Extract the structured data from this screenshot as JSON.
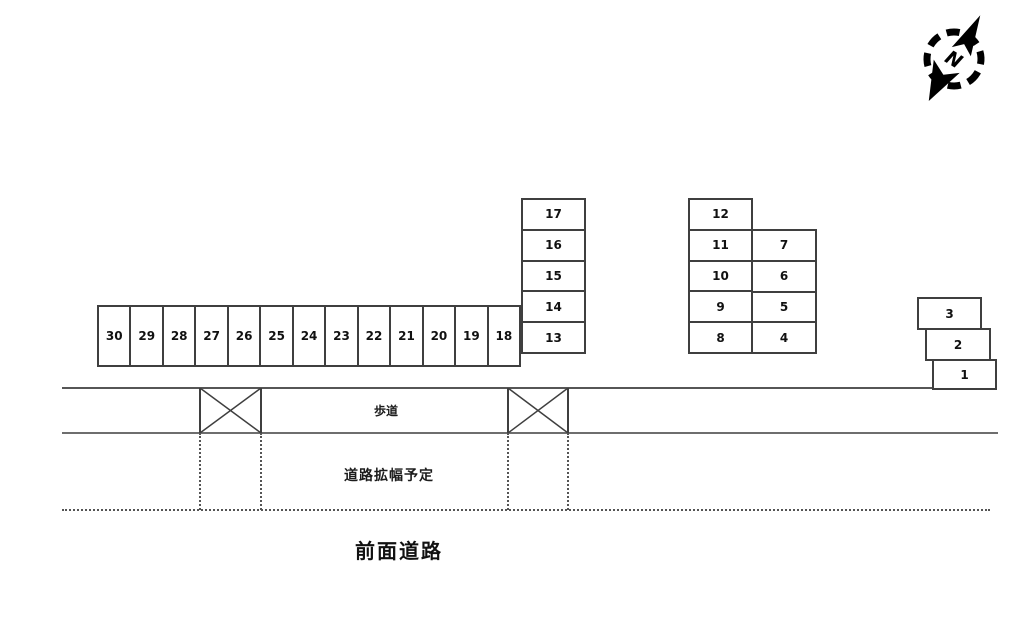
{
  "compass": {
    "label": "N"
  },
  "parking": {
    "row_bottom": [
      "30",
      "29",
      "28",
      "27",
      "26",
      "25",
      "24",
      "23",
      "22",
      "21",
      "20",
      "19",
      "18"
    ],
    "column_left": [
      "17",
      "16",
      "15",
      "14",
      "13"
    ],
    "column_mid_left": [
      "12",
      "11",
      "10",
      "9",
      "8"
    ],
    "column_mid_right": [
      "7",
      "6",
      "5",
      "4"
    ],
    "staircase": [
      "3",
      "2",
      "1"
    ]
  },
  "labels": {
    "sidewalk": "歩道",
    "road_widening": "道路拡幅予定",
    "front_road": "前面道路"
  },
  "colors": {
    "box_border": "#3f3f3f",
    "line_dark": "#565656",
    "line_mid": "#6e6e6e",
    "text": "#111111"
  }
}
